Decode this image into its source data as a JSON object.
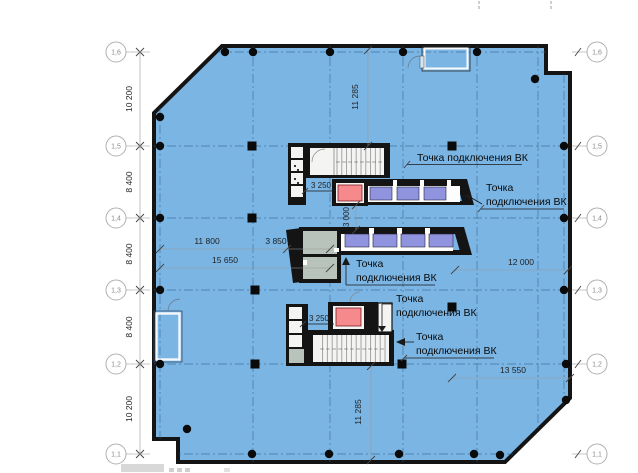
{
  "colors": {
    "floor": "#7ab5e4",
    "wall": "#141414",
    "elevator": "#9094de",
    "highlight": "#f5898b",
    "service": "#b7c3bb",
    "grid": "#2f5b84"
  },
  "axes": {
    "left": [
      "1,6",
      "1,5",
      "1,4",
      "1,3",
      "1,2",
      "1,1"
    ],
    "right": [
      "1,6",
      "1,5",
      "1,4",
      "1,3",
      "1,2",
      "1,1"
    ]
  },
  "dims": {
    "left_col": [
      "10 200",
      "8 400",
      "8 400",
      "8 400",
      "10 200"
    ],
    "v_top": "11 285",
    "v_mid": "3 000",
    "v_bottom": "11 285",
    "h1": "11 800",
    "h2": "3 850",
    "h3": "15 650",
    "h4": "12 000",
    "h5": "13 550",
    "core_top": "3 250",
    "core_bottom": "3 250"
  },
  "callouts": [
    {
      "line1": "Точка подключения ВК"
    },
    {
      "line1": "Точка",
      "line2": "подключения ВК"
    },
    {
      "line1": "Точка",
      "line2": "подключения ВК"
    },
    {
      "line1": "Точка",
      "line2": "подключения ВК"
    },
    {
      "line1": "Точка",
      "line2": "подключения ВК"
    }
  ]
}
